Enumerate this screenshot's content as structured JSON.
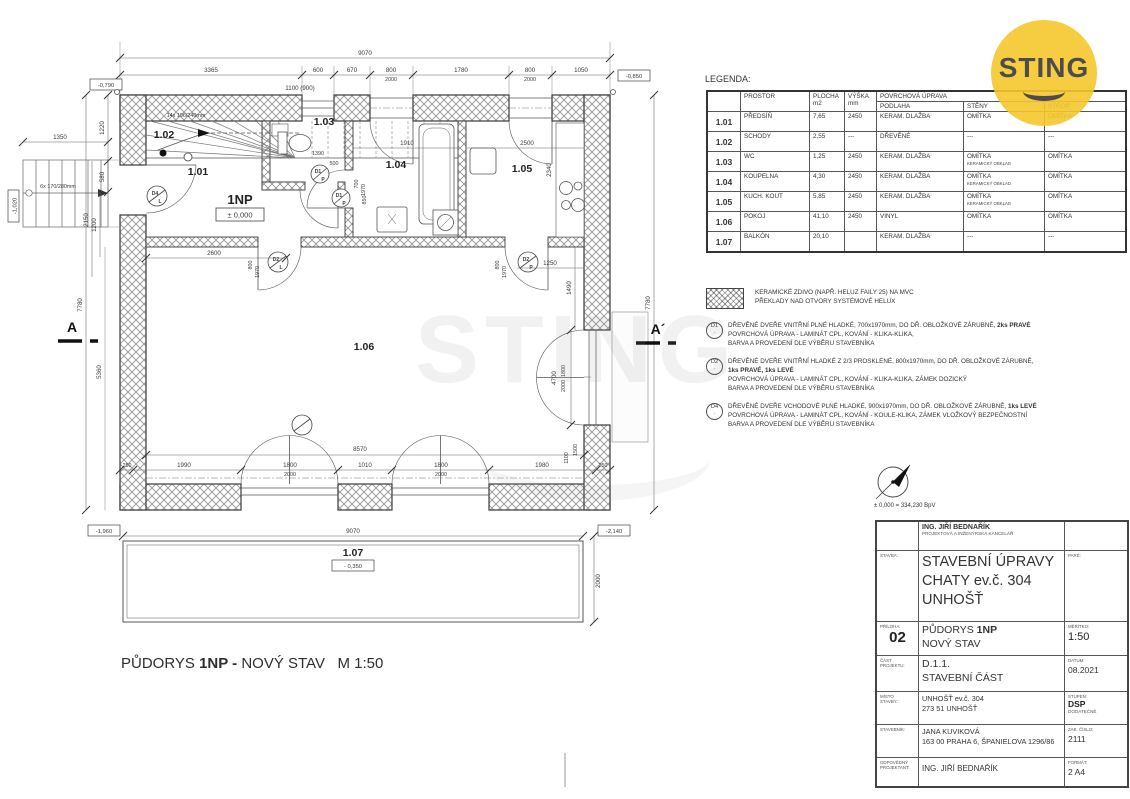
{
  "logo": {
    "brand": "STING"
  },
  "watermark": {
    "text": "STING"
  },
  "caption": {
    "pre": "PŮDORYS ",
    "bold": "1NP -",
    "post": " NOVÝ STAV   M 1:50"
  },
  "plan": {
    "rooms": {
      "r101": "1.01",
      "r102": "1.02",
      "r103": "1.03",
      "r104": "1.04",
      "r105": "1.05",
      "r106": "1.06",
      "r107": "1.07",
      "floor": "1NP",
      "level": "± 0,000"
    },
    "stairs": {
      "inner": "14x 196/240mm",
      "outer": "6x 170/280mm"
    },
    "section": {
      "a": "A",
      "ap": "A´"
    },
    "doors": {
      "d1": "D1",
      "d1s": "P",
      "d2": "D2",
      "d2l": "L",
      "d2p": "P",
      "d4": "D4",
      "d4s": "L"
    },
    "levels": {
      "v1": "-0,790",
      "v2": "-0,850",
      "v3": "-1,020",
      "v4": "-1,960",
      "v5": "-2,140",
      "v6": "- 0,350"
    },
    "dims": {
      "t_total": "9070",
      "t1": "3365",
      "t2": "600",
      "t3": "670",
      "t4": "800",
      "t4b": "2000",
      "t5": "1780",
      "t6": "800",
      "t6b": "2000",
      "t7": "1050",
      "t8": "1100 (900)",
      "l1": "1220",
      "l2": "580",
      "l3": "1200",
      "l4": "2150",
      "l5": "5360",
      "l6": "7780",
      "l7": "1350",
      "r1": "7780",
      "r2": "2340",
      "r3": "1250",
      "r4": "1490",
      "r5": "4700",
      "r6": "1800",
      "r6b": "2000",
      "r7": "2000",
      "r8": "1100",
      "r9": "1500",
      "b_in": "8570",
      "b1": "250",
      "b2": "1990",
      "b3": "1800",
      "b3b": "2000",
      "b4": "1010",
      "b5": "1800",
      "b5b": "2000",
      "b6": "1980",
      "b7": "250",
      "b_total": "9070",
      "i1": "2600",
      "i2": "1910",
      "i3": "2500",
      "i4": "1390",
      "i5": "500",
      "i6": "850",
      "i7": "700",
      "i7b": "1970",
      "i8": "800",
      "i8b": "1970",
      "i9": "800",
      "i9b": "1970"
    }
  },
  "legend": {
    "title": "LEGENDA:",
    "h_prostor": "PROSTOR",
    "h_plocha": "PLOCHA",
    "h_plocha2": "m2",
    "h_vyska": "VÝŠKA",
    "h_vyska2": "mm",
    "h_povrch": "POVRCHOVÁ ÚPRAVA",
    "h_podlaha": "PODLAHA",
    "h_steny": "STĚNY",
    "h_strop": "STROP",
    "rows": [
      {
        "id": "1.01",
        "name": "PŘEDSÍŇ",
        "area": "7,65",
        "height": "2450",
        "floor": "KERAM. DLAŽBA",
        "walls": "OMÍTKA",
        "walls2": "",
        "ceiling": "OMÍTKA"
      },
      {
        "id": "1.02",
        "name": "SCHODY",
        "area": "2,55",
        "height": "---",
        "floor": "DŘEVĚNÉ",
        "walls": "---",
        "walls2": "",
        "ceiling": "---"
      },
      {
        "id": "1.03",
        "name": "WC",
        "area": "1,25",
        "height": "2450",
        "floor": "KERAM. DLAŽBA",
        "walls": "OMÍTKA",
        "walls2": "KERAMICKÝ OBKLAD",
        "ceiling": "OMÍTKA"
      },
      {
        "id": "1.04",
        "name": "KOUPELNA",
        "area": "4,30",
        "height": "2450",
        "floor": "KERAM. DLAŽBA",
        "walls": "OMÍTKA",
        "walls2": "KERAMICKÝ OBKLAD",
        "ceiling": "OMÍTKA"
      },
      {
        "id": "1.05",
        "name": "KUCH. KOUT",
        "area": "5,85",
        "height": "2450",
        "floor": "KERAM. DLAŽBA",
        "walls": "OMÍTKA",
        "walls2": "KERAMICKÝ OBKLAD",
        "ceiling": "OMÍTKA"
      },
      {
        "id": "1.06",
        "name": "POKOJ",
        "area": "41,10",
        "height": "2450",
        "floor": "VINYL",
        "walls": "OMÍTKA",
        "walls2": "",
        "ceiling": "OMÍTKA"
      },
      {
        "id": "1.07",
        "name": "BALKÓN",
        "area": "20,10",
        "height": "",
        "floor": "KERAM. DLAŽBA",
        "walls": "---",
        "walls2": "",
        "ceiling": "---"
      }
    ]
  },
  "notes": {
    "masonry1": "KERAMICKÉ ZDIVO (NAPŘ. HELUZ FAILY 25) NA MVC",
    "masonry2": "PŘEKLADY NAD OTVORY SYSTÉMOVÉ HELUX",
    "d1_label": "D1",
    "d1_line1a": "DŘEVĚNÉ DVEŘE VNITŘNÍ PLNÉ HLADKÉ, 700x1970mm, DO DŘ. OBLOŽKOVÉ ZÁRUBNĚ, ",
    "d1_line1b": "2ks PRAVÉ",
    "d1_line2": "POVRCHOVÁ ÚPRAVA - LAMINÁT CPL, KOVÁNÍ - KLIKA-KLIKA,",
    "d1_line3": "BARVA A PROVEDENÍ DLE VÝBĚRU STAVEBNÍKA",
    "d2_label": "D2",
    "d2_line1a": "DŘEVĚNÉ DVEŘE VNITŘNÍ HLADKÉ Z 2/3 PROSKLENÉ, 800x1970mm, DO DŘ. OBLOŽKOVÉ ZÁRUBNĚ,",
    "d2_line1b": "1ks PRAVÉ, 1ks LEVÉ",
    "d2_line2": "POVRCHOVÁ ÚPRAVA - LAMINÁT CPL, KOVÁNÍ - KLIKA-KLIKA, ZÁMEK DOZICKÝ",
    "d2_line3": "BARVA A PROVEDENÍ DLE VÝBĚRU STAVEBNÍKA",
    "d4_label": "D4",
    "d4_line1a": "DŘEVĚNÉ DVEŘE VCHODOVÉ PLNÉ HLADKÉ, 900x1970mm, DO DŘ. OBLOŽKOVÉ ZÁRUBNĚ, ",
    "d4_line1b": "1ks LEVÉ",
    "d4_line2": "POVRCHOVÁ ÚPRAVA - LAMINÁT CPL, KOVÁNÍ - KOULE-KLIKA, ZÁMEK VLOŽKOVÝ BEZPEČNOSTNÍ",
    "d4_line3": "BARVA A PROVEDENÍ DLE VÝBĚRU STAVEBNÍKA"
  },
  "north": {
    "datum": "± 0,000 = 334,230 BpV"
  },
  "titleblock": {
    "office1": "ING. JIŘÍ BEDNAŘÍK",
    "office2": "PROJEKTOVÁ A INŽENÝRSKÁ KANCELÁŘ",
    "stavba_label": "STAVBA:",
    "stavba1": "STAVEBNÍ ÚPRAVY",
    "stavba2": "CHATY ev.č. 304",
    "stavba3": "UNHOŠŤ",
    "pare_label": "PARÉ:",
    "priloha_label": "PŘÍLOHA:",
    "priloha_num": "02",
    "priloha1a": "PŮDORYS ",
    "priloha1b": "1NP",
    "priloha2": "NOVÝ STAV",
    "meritko_label": "MĚŘÍTKO:",
    "meritko": "1:50",
    "cast_label1": "ČÁST",
    "cast_label2": "PROJEKTU:",
    "cast1": "D.1.1.",
    "cast2": "STAVEBNÍ ČÁST",
    "datum_label": "DATUM:",
    "datum": "08.2021",
    "misto_label1": "MÍSTO",
    "misto_label2": "STAVBY:",
    "misto1": "UNHOŠŤ ev.č. 304",
    "misto2": "273 51 UNHOŠŤ",
    "stupen_label": "STUPEŇ:",
    "stupen1": "DSP",
    "stupen2": "DODATEČNĚ",
    "stavebnik_label": "STAVEBNÍK:",
    "stavebnik1": "JANA KUVIKOVÁ",
    "stavebnik2": "163 00 PRAHA 6, ŠPANIELOVA 1296/86",
    "zak_label": "ZAK. ČÍSLO:",
    "zak": "2111",
    "odp_label1": "ODPOVĚDNÝ",
    "odp_label2": "PROJEKTANT:",
    "odp": "ING. JIŘÍ BEDNAŘÍK",
    "format_label": "FORMÁT:",
    "format": "2 A4"
  }
}
